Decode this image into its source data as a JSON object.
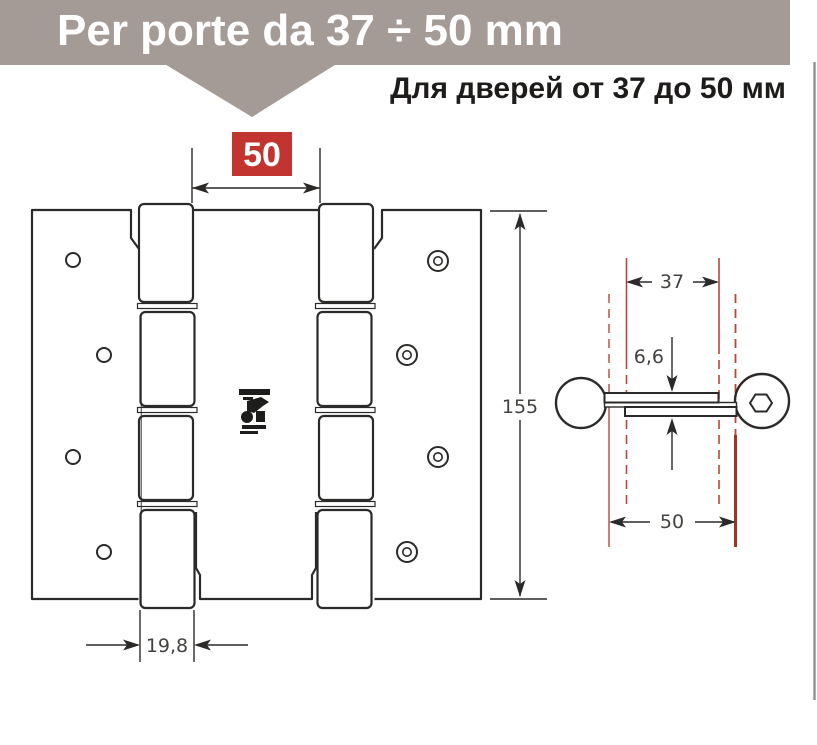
{
  "banner": {
    "title": "Per porte da 37 ÷ 50 mm",
    "bg_color": "#a49b97",
    "text_color": "#ffffff"
  },
  "subtitle": {
    "text": "Для дверей от 37 до 50 мм",
    "color": "#1d1c1a"
  },
  "front_view": {
    "description": "double-action spring hinge, front view",
    "width_badge": {
      "value": "50",
      "bg_color": "#c23430",
      "text_color": "#ffffff"
    },
    "height_dim": "155",
    "knuckle_dim": "19,8"
  },
  "side_view": {
    "description": "hinge top view with door thickness guides",
    "min_door_dim": "37",
    "plate_dim": "6,6",
    "max_door_dim": "50",
    "guide_color": "#b8453c",
    "guide_color_dark": "#a53227"
  },
  "stamp": {
    "icon": "manufacturer-stamp"
  },
  "colors": {
    "line": "#2b2a28",
    "dim_text": "#44423e",
    "edge_line": "#8f8b88"
  }
}
